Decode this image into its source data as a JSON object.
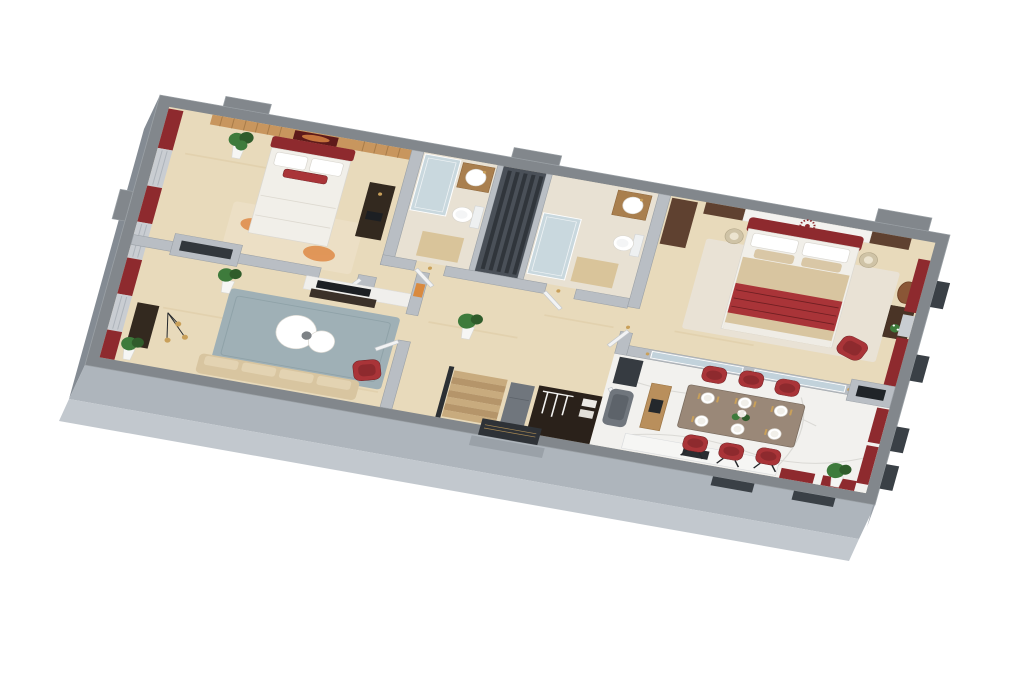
{
  "view": {
    "description": "3D rendered top-down apartment floor plan on white background",
    "width_px": 1024,
    "height_px": 683
  },
  "palette": {
    "background": "#ffffff",
    "wallTop": "#82878c",
    "wallEdge": "#9aa0a5",
    "wallFaceLight": "#aeb5bc",
    "wallFaceMid": "#848b93",
    "wallFaceRight": "#99a0a8",
    "plinth": "#c2c8ce",
    "innerWall": "#b9bec4",
    "innerWallStroke": "#9aa0a6",
    "floorWood": "#e8dabb",
    "floorWoodShade": "#ddcba4",
    "tileBath": "#e8e1d3",
    "bathMat": "#d9c49a",
    "floorMarble": "#f2f1ee",
    "marbleVein": "#d7d6d2",
    "woodSlat": "#c8965e",
    "woodSlatDark": "#a87c49",
    "woodDark": "#5f4130",
    "furnitureDark": "#33291f",
    "darkDoor": "#2e3237",
    "accentRed": "#8e2a2e",
    "accentRedBright": "#a93438",
    "maroonDark": "#6f1f22",
    "curtainSilver": "#c9cdd2",
    "curtainSilverLine": "#aeb4bb",
    "rugBlue": "#9fb0b6",
    "rugCream": "#ecdfc5",
    "rugOrange": "#df8a45",
    "sofaBeige": "#d8c5a0",
    "tableTaupe": "#9a8878",
    "plantGreen": "#3e7b3c",
    "plantGreenDark": "#2f5c2b",
    "potWhite": "#f6f6f4",
    "glassBlue": "#c3d6df",
    "gold": "#c9a05a",
    "doorWhite": "#f2f3f4",
    "stairWood": "#c8ab7e",
    "stairWoodDark": "#b5956a",
    "white": "#ffffff",
    "mattressWhite": "#f1efe9",
    "windowBox": "#3a4046",
    "shaftDark": "#4a5058",
    "shaftSlat": "#30353b",
    "applianceGray": "#70767d",
    "mirrorBrown": "#8a5636",
    "artOrange": "#d98a3f"
  },
  "scene": {
    "rooms": [
      {
        "id": "bedroom-2",
        "furniture": [
          "double-bed",
          "wood-accent-wall",
          "wall-art",
          "area-rug",
          "dresser",
          "potted-plant",
          "window-curtains"
        ]
      },
      {
        "id": "living-room",
        "furniture": [
          "sofa",
          "coffee-table",
          "accent-armchair",
          "tv-wall",
          "media-console",
          "area-rug",
          "pendant-lamp",
          "side-console",
          "potted-plants",
          "window-curtains"
        ]
      },
      {
        "id": "bathroom-1",
        "furniture": [
          "shower",
          "vanity-sink",
          "toilet",
          "bath-mat"
        ]
      },
      {
        "id": "utility-shaft",
        "furniture": []
      },
      {
        "id": "bathroom-2",
        "furniture": [
          "shower",
          "vanity-sink",
          "toilet",
          "bath-mat"
        ]
      },
      {
        "id": "hallway",
        "furniture": [
          "interior-doors",
          "staircase",
          "entry-closet",
          "entry-door",
          "potted-plant",
          "gold-sconces"
        ]
      },
      {
        "id": "master-bedroom",
        "furniture": [
          "king-bed",
          "headboard-wall-medallion",
          "nightstands",
          "table-lamps",
          "wall-mirror",
          "dressing-console",
          "accent-armchair",
          "wardrobe",
          "window-curtains"
        ]
      },
      {
        "id": "kitchen-dining",
        "furniture": [
          "dining-table",
          "dining-chairs-x6",
          "dinner-plates-x6",
          "centerpiece-flowers",
          "kitchen-counter",
          "cooktop",
          "wood-island",
          "refrigerator",
          "appliance",
          "fireplace-niche",
          "potted-plant",
          "window-curtains"
        ]
      }
    ]
  }
}
